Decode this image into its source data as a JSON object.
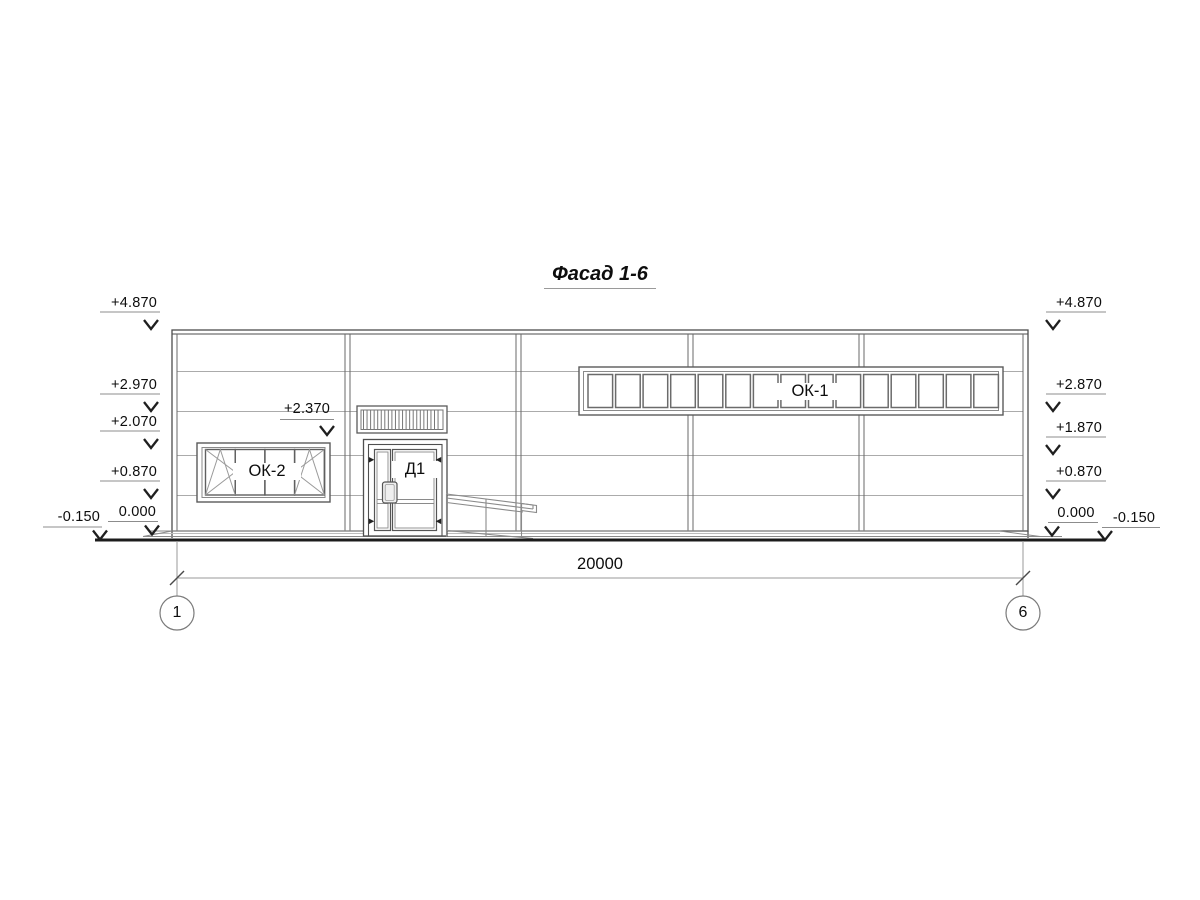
{
  "title": "Фасад 1-6",
  "facade": {
    "window_band_label": "ОК-1",
    "window_label": "ОК-2",
    "door_label": "Д1",
    "louver_elevation": "+2.370",
    "ok1_pane_count": 15,
    "ok2_pane_count": 4
  },
  "elevations": {
    "left": [
      "+4.870",
      "+2.970",
      "+2.070",
      "+0.870",
      "0.000",
      "-0.150"
    ],
    "right": [
      "+4.870",
      "+2.870",
      "+1.870",
      "+0.870",
      "0.000",
      "-0.150"
    ]
  },
  "dimensions": {
    "overall": "20000"
  },
  "axes": {
    "left": "1",
    "right": "6"
  },
  "colors": {
    "background": "#ffffff",
    "line_dark": "#4d4d4d",
    "line_light": "#ababab",
    "line_leader": "#8c8c8c",
    "arrow": "#1f1f1f",
    "ground": "#1c1c1c",
    "text": "#0d0d0d"
  }
}
